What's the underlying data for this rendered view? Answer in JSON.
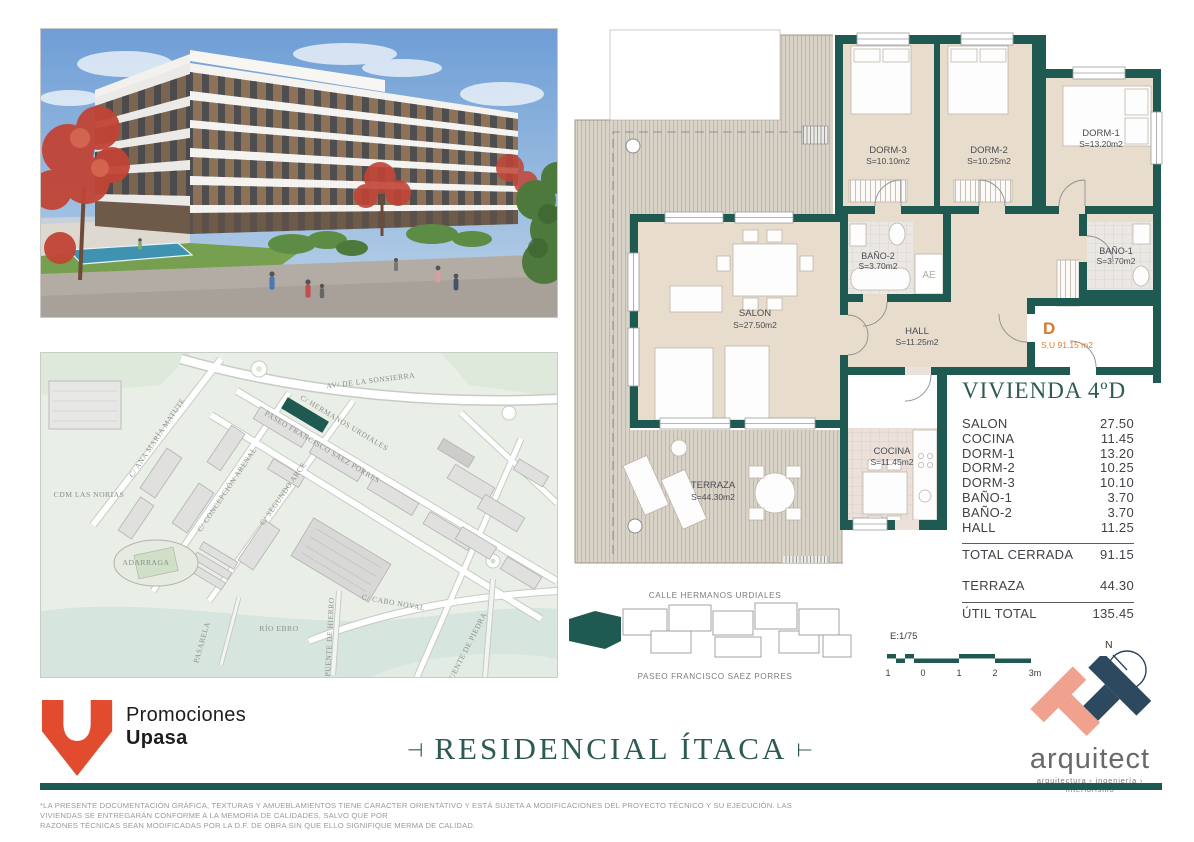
{
  "floor_plan": {
    "rooms": [
      {
        "name": "DORM-3",
        "area": "S=10.10m2"
      },
      {
        "name": "DORM-2",
        "area": "S=10.25m2"
      },
      {
        "name": "DORM-1",
        "area": "S=13.20m2"
      },
      {
        "name": "BAÑO-2",
        "area": "S=3.70m2"
      },
      {
        "name": "BAÑO-1",
        "area": "S=3.70m2"
      },
      {
        "name": "SALON",
        "area": "S=27.50m2"
      },
      {
        "name": "HALL",
        "area": "S=11.25m2"
      },
      {
        "name": "COCINA",
        "area": "S=11.45m2"
      },
      {
        "name": "TERRAZA",
        "area": "S=44.30m2"
      }
    ],
    "closet_label": "AE",
    "unit_letter": "D",
    "unit_area": "S.U 91.15 m2"
  },
  "area_table": {
    "title": "VIVIENDA 4ºD",
    "rows": [
      {
        "label": "SALON",
        "value": "27.50"
      },
      {
        "label": "COCINA",
        "value": "11.45"
      },
      {
        "label": "DORM-1",
        "value": "13.20"
      },
      {
        "label": "DORM-2",
        "value": "10.25"
      },
      {
        "label": "DORM-3",
        "value": "10.10"
      },
      {
        "label": "BAÑO-1",
        "value": "3.70"
      },
      {
        "label": "BAÑO-2",
        "value": "3.70"
      },
      {
        "label": "HALL",
        "value": "11.25"
      }
    ],
    "total_row": {
      "label": "TOTAL CERRADA",
      "value": "91.15"
    },
    "terraza_row": {
      "label": "TERRAZA",
      "value": "44.30"
    },
    "util_row": {
      "label": "ÚTIL TOTAL",
      "value": "135.45"
    }
  },
  "key_plan": {
    "street_top": "CALLE HERMANOS URDIALES",
    "street_bottom": "PASEO FRANCISCO SAEZ PORRES"
  },
  "scale": {
    "label": "E:1/75",
    "ticks": [
      "1",
      "0",
      "1",
      "2",
      "3m"
    ]
  },
  "compass": {
    "label": "N"
  },
  "map": {
    "labels": [
      {
        "text": "AV/ DE LA SONSIERRA"
      },
      {
        "text": "C/ HERMANOS URDIALES"
      },
      {
        "text": "PASEO FRANCISCO SAEZ PORRES"
      },
      {
        "text": "C/ ANA MARÍA MATUTE"
      },
      {
        "text": "C/ SEGUNDO ARCE"
      },
      {
        "text": "C/ CONCEPCIÓN ARENAL"
      },
      {
        "text": "CDM LAS NORIAS"
      },
      {
        "text": "ADARRAGA"
      },
      {
        "text": "RÍO EBRO"
      },
      {
        "text": "PASARELA"
      },
      {
        "text": "PUENTE DE HIERRO"
      },
      {
        "text": "C/ CABO NOVAL"
      },
      {
        "text": "PUENTE DE PIEDRA"
      }
    ]
  },
  "branding": {
    "developer_line1": "Promociones",
    "developer_line2": "Upasa",
    "project_title": "RESIDENCIAL ÍTACA",
    "title_left_mark": "⊣",
    "title_right_mark": "⊢",
    "architect_name": "arquitect",
    "architect_tagline": "arquitectura › ingeniería › interiorismo"
  },
  "disclaimer": {
    "line1": "*LA PRESENTE DOCUMENTACIÓN GRÁFICA, TEXTURAS Y AMUEBLAMIENTOS TIENE CARACTER ORIENTATIVO Y ESTÁ SUJETA A MODIFICACIONES DEL PROYECTO TÉCNICO Y SU EJECUCIÓN. LAS VIVIENDAS SE ENTREGARÁN CONFORME A LA MEMORIA DE CALIDADES, SALVO QUE POR",
    "line2": "RAZONES TÉCNICAS SEAN MODIFICADAS POR LA D.F. DE OBRA SIN QUE ELLO SIGNIFIQUE MERMA DE CALIDAD."
  },
  "colors": {
    "wall_teal": "#1f5a52",
    "title_teal": "#2d5a52",
    "unit_orange": "#d97a33",
    "upasa_red": "#e14b2e",
    "architect_salmon": "#f0a28e",
    "architect_navy": "#2d4960"
  }
}
